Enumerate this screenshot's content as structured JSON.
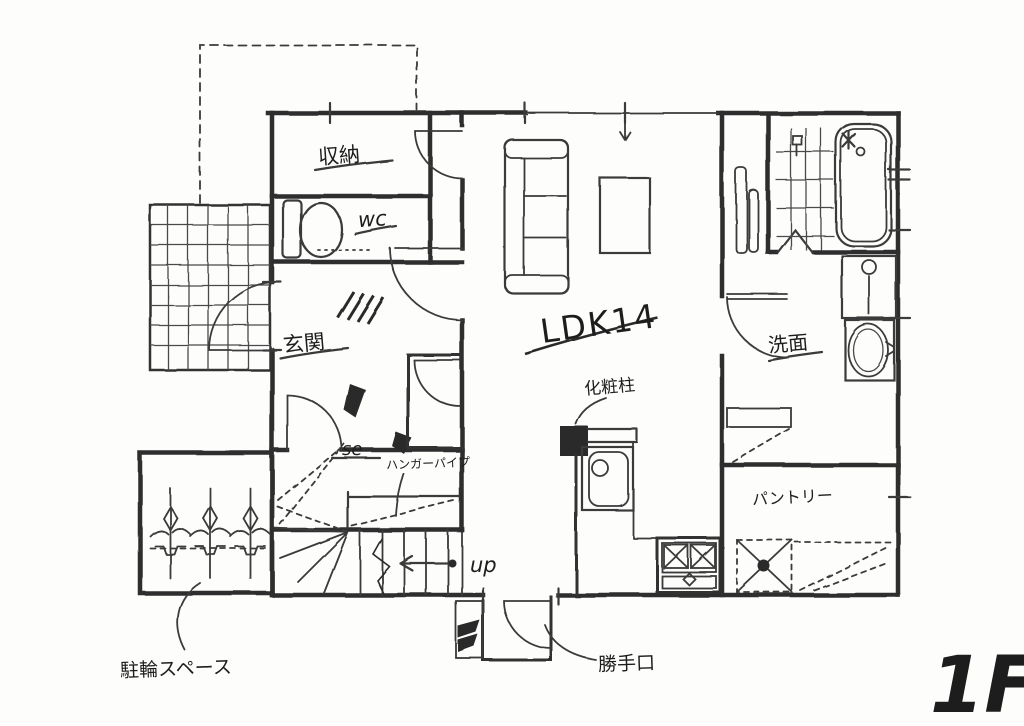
{
  "title": "1F hand-drawn floor plan",
  "colors": {
    "ink": "#2e2e2e",
    "paper": "#fdfdfc"
  },
  "labels": {
    "storage": "収納",
    "wc": "wc",
    "entrance": "玄関",
    "ldk": "LDK14",
    "pillar": "化粧柱",
    "washroom": "洗面",
    "closet": "se",
    "hanger_pipe": "ハンガーパイプ",
    "pantry": "パントリー",
    "stairs_up": "up",
    "back_door": "勝手口",
    "bicycle_space": "駐輪スペース",
    "floor": "1F"
  }
}
